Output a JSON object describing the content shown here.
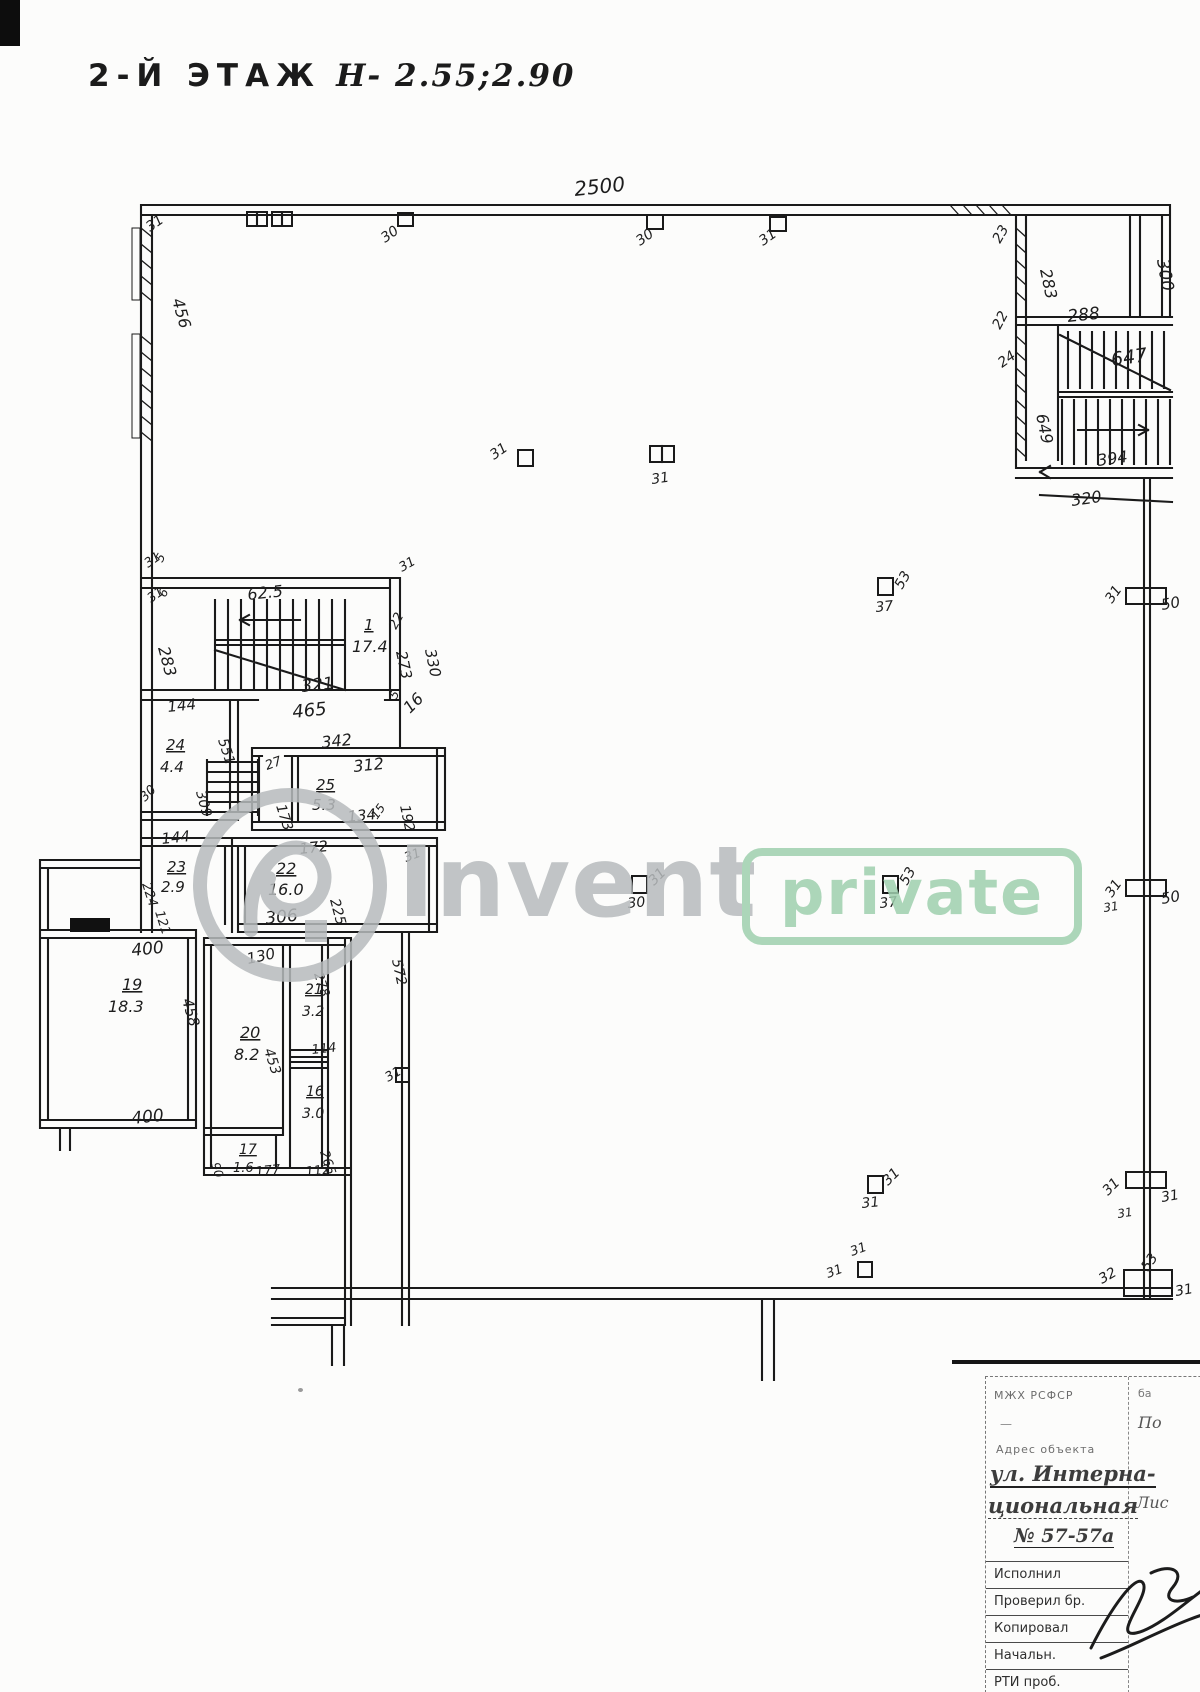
{
  "page": {
    "title_prefix": "2-Й ЭТАЖ",
    "title_value": "Н- 2.55;2.90"
  },
  "colors": {
    "ink": "#1b1b1b",
    "paper": "#fcfcfb",
    "watermark_gray": "#b7bbbd",
    "watermark_green": "#9fd0ae"
  },
  "watermark": {
    "brand": "Invent",
    "badge": "private"
  },
  "plan": {
    "labels": [
      {
        "t": "2500",
        "x": 575,
        "y": 196,
        "r": -6,
        "s": 20
      },
      {
        "t": "31",
        "x": 150,
        "y": 232,
        "r": -35,
        "s": 14
      },
      {
        "t": "30",
        "x": 385,
        "y": 243,
        "r": -35,
        "s": 14
      },
      {
        "t": "30",
        "x": 640,
        "y": 246,
        "r": -35,
        "s": 14
      },
      {
        "t": "31",
        "x": 763,
        "y": 246,
        "r": -35,
        "s": 14
      },
      {
        "t": "23",
        "x": 1000,
        "y": 244,
        "r": -60,
        "s": 14
      },
      {
        "t": "456",
        "x": 172,
        "y": 300,
        "r": 74,
        "s": 16
      },
      {
        "t": "283",
        "x": 1040,
        "y": 270,
        "r": 78,
        "s": 16
      },
      {
        "t": "288",
        "x": 1068,
        "y": 322,
        "r": -6,
        "s": 17
      },
      {
        "t": "300",
        "x": 1157,
        "y": 260,
        "r": 80,
        "s": 17
      },
      {
        "t": "22",
        "x": 1000,
        "y": 330,
        "r": -62,
        "s": 14
      },
      {
        "t": "24",
        "x": 1002,
        "y": 368,
        "r": -35,
        "s": 14
      },
      {
        "t": "647",
        "x": 1112,
        "y": 366,
        "r": -8,
        "s": 19
      },
      {
        "t": "649",
        "x": 1036,
        "y": 415,
        "r": 78,
        "s": 16
      },
      {
        "t": "394",
        "x": 1098,
        "y": 466,
        "r": -8,
        "s": 16
      },
      {
        "t": "320",
        "x": 1072,
        "y": 506,
        "r": -8,
        "s": 16
      },
      {
        "t": "31",
        "x": 148,
        "y": 568,
        "r": -35,
        "s": 13
      },
      {
        "t": "5",
        "x": 162,
        "y": 563,
        "r": -60,
        "s": 12
      },
      {
        "t": "31",
        "x": 151,
        "y": 603,
        "r": -35,
        "s": 13
      },
      {
        "t": "6",
        "x": 165,
        "y": 598,
        "r": -60,
        "s": 12
      },
      {
        "t": "62.5",
        "x": 248,
        "y": 600,
        "r": -6,
        "s": 16
      },
      {
        "t": "31",
        "x": 402,
        "y": 572,
        "r": -30,
        "s": 13
      },
      {
        "t": "22",
        "x": 396,
        "y": 630,
        "r": -62,
        "s": 13
      },
      {
        "t": "1",
        "x": 364,
        "y": 630,
        "r": 0,
        "s": 15,
        "u": true
      },
      {
        "t": "17.4",
        "x": 352,
        "y": 652,
        "r": 0,
        "s": 16
      },
      {
        "t": "273",
        "x": 396,
        "y": 652,
        "r": 78,
        "s": 15
      },
      {
        "t": "330",
        "x": 425,
        "y": 650,
        "r": 78,
        "s": 15
      },
      {
        "t": "283",
        "x": 158,
        "y": 648,
        "r": 75,
        "s": 16
      },
      {
        "t": "321",
        "x": 302,
        "y": 692,
        "r": -6,
        "s": 17
      },
      {
        "t": "465",
        "x": 293,
        "y": 718,
        "r": -6,
        "s": 18
      },
      {
        "t": "5",
        "x": 396,
        "y": 700,
        "r": -60,
        "s": 12
      },
      {
        "t": "16",
        "x": 410,
        "y": 714,
        "r": -45,
        "s": 16
      },
      {
        "t": "144",
        "x": 168,
        "y": 712,
        "r": -6,
        "s": 15
      },
      {
        "t": "551",
        "x": 218,
        "y": 740,
        "r": 72,
        "s": 14
      },
      {
        "t": "24",
        "x": 166,
        "y": 750,
        "r": 0,
        "s": 15,
        "u": true
      },
      {
        "t": "4.4",
        "x": 160,
        "y": 772,
        "r": 0,
        "s": 15
      },
      {
        "t": "309",
        "x": 196,
        "y": 792,
        "r": 75,
        "s": 14
      },
      {
        "t": "30",
        "x": 145,
        "y": 802,
        "r": -45,
        "s": 13
      },
      {
        "t": "342",
        "x": 322,
        "y": 748,
        "r": -6,
        "s": 16
      },
      {
        "t": "27",
        "x": 267,
        "y": 770,
        "r": -20,
        "s": 13
      },
      {
        "t": "312",
        "x": 354,
        "y": 772,
        "r": -6,
        "s": 16
      },
      {
        "t": "25",
        "x": 316,
        "y": 790,
        "r": 0,
        "s": 15,
        "u": true
      },
      {
        "t": "5.3",
        "x": 312,
        "y": 810,
        "r": 0,
        "s": 15
      },
      {
        "t": "173",
        "x": 276,
        "y": 806,
        "r": 72,
        "s": 14
      },
      {
        "t": "192",
        "x": 400,
        "y": 806,
        "r": 78,
        "s": 14
      },
      {
        "t": "134",
        "x": 348,
        "y": 822,
        "r": -6,
        "s": 15
      },
      {
        "t": "15",
        "x": 377,
        "y": 820,
        "r": -55,
        "s": 12
      },
      {
        "t": "172",
        "x": 300,
        "y": 854,
        "r": -6,
        "s": 15
      },
      {
        "t": "31",
        "x": 406,
        "y": 862,
        "r": -20,
        "s": 13
      },
      {
        "t": "144",
        "x": 162,
        "y": 844,
        "r": -6,
        "s": 15
      },
      {
        "t": "23",
        "x": 167,
        "y": 872,
        "r": 0,
        "s": 15,
        "u": true
      },
      {
        "t": "2.9",
        "x": 161,
        "y": 892,
        "r": 0,
        "s": 15
      },
      {
        "t": "224",
        "x": 142,
        "y": 884,
        "r": 72,
        "s": 13
      },
      {
        "t": "121",
        "x": 155,
        "y": 912,
        "r": 72,
        "s": 13
      },
      {
        "t": "22",
        "x": 276,
        "y": 874,
        "r": 0,
        "s": 16,
        "u": true
      },
      {
        "t": "16.0",
        "x": 268,
        "y": 895,
        "r": 0,
        "s": 16
      },
      {
        "t": "225",
        "x": 330,
        "y": 900,
        "r": 75,
        "s": 14
      },
      {
        "t": "306",
        "x": 266,
        "y": 924,
        "r": -6,
        "s": 17
      },
      {
        "t": "400",
        "x": 132,
        "y": 956,
        "r": -6,
        "s": 17
      },
      {
        "t": "19",
        "x": 122,
        "y": 990,
        "r": 0,
        "s": 16,
        "u": true
      },
      {
        "t": "18.3",
        "x": 108,
        "y": 1012,
        "r": 0,
        "s": 16
      },
      {
        "t": "458",
        "x": 182,
        "y": 1000,
        "r": 74,
        "s": 15
      },
      {
        "t": "400",
        "x": 132,
        "y": 1124,
        "r": -6,
        "s": 17
      },
      {
        "t": "130",
        "x": 248,
        "y": 964,
        "r": -12,
        "s": 15
      },
      {
        "t": "278",
        "x": 314,
        "y": 974,
        "r": 72,
        "s": 13
      },
      {
        "t": "21",
        "x": 305,
        "y": 994,
        "r": 0,
        "s": 14,
        "u": true
      },
      {
        "t": "3.2",
        "x": 302,
        "y": 1016,
        "r": 0,
        "s": 14
      },
      {
        "t": "20",
        "x": 240,
        "y": 1038,
        "r": 0,
        "s": 16,
        "u": true
      },
      {
        "t": "8.2",
        "x": 234,
        "y": 1060,
        "r": 0,
        "s": 16
      },
      {
        "t": "453",
        "x": 264,
        "y": 1050,
        "r": 72,
        "s": 14
      },
      {
        "t": "114",
        "x": 312,
        "y": 1054,
        "r": -6,
        "s": 13
      },
      {
        "t": "572",
        "x": 392,
        "y": 960,
        "r": 78,
        "s": 14
      },
      {
        "t": "31",
        "x": 388,
        "y": 1082,
        "r": -30,
        "s": 13
      },
      {
        "t": "16",
        "x": 306,
        "y": 1096,
        "r": 0,
        "s": 14,
        "u": true
      },
      {
        "t": "3.0",
        "x": 302,
        "y": 1118,
        "r": 0,
        "s": 14
      },
      {
        "t": "265",
        "x": 320,
        "y": 1152,
        "r": 72,
        "s": 13
      },
      {
        "t": "17",
        "x": 239,
        "y": 1154,
        "r": 0,
        "s": 14,
        "u": true
      },
      {
        "t": "1.6",
        "x": 233,
        "y": 1172,
        "r": 0,
        "s": 13
      },
      {
        "t": "90",
        "x": 211,
        "y": 1164,
        "r": 72,
        "s": 12
      },
      {
        "t": "177",
        "x": 256,
        "y": 1176,
        "r": -6,
        "s": 13
      },
      {
        "t": "112",
        "x": 306,
        "y": 1176,
        "r": -6,
        "s": 13
      },
      {
        "t": "31",
        "x": 494,
        "y": 460,
        "r": -35,
        "s": 14
      },
      {
        "t": "31",
        "x": 652,
        "y": 484,
        "r": -8,
        "s": 14
      },
      {
        "t": "53",
        "x": 902,
        "y": 590,
        "r": -60,
        "s": 14
      },
      {
        "t": "37",
        "x": 876,
        "y": 612,
        "r": -6,
        "s": 14
      },
      {
        "t": "30",
        "x": 628,
        "y": 908,
        "r": -6,
        "s": 14
      },
      {
        "t": "31",
        "x": 654,
        "y": 886,
        "r": -45,
        "s": 14
      },
      {
        "t": "53",
        "x": 907,
        "y": 886,
        "r": -60,
        "s": 14
      },
      {
        "t": "37",
        "x": 880,
        "y": 908,
        "r": -6,
        "s": 14
      },
      {
        "t": "31",
        "x": 862,
        "y": 1208,
        "r": -6,
        "s": 14
      },
      {
        "t": "31",
        "x": 888,
        "y": 1186,
        "r": -45,
        "s": 14
      },
      {
        "t": "31",
        "x": 852,
        "y": 1256,
        "r": -20,
        "s": 13
      },
      {
        "t": "31",
        "x": 828,
        "y": 1278,
        "r": -20,
        "s": 13
      },
      {
        "t": "31",
        "x": 1112,
        "y": 604,
        "r": -55,
        "s": 14
      },
      {
        "t": "50",
        "x": 1162,
        "y": 610,
        "r": -10,
        "s": 15
      },
      {
        "t": "31",
        "x": 1112,
        "y": 898,
        "r": -55,
        "s": 14
      },
      {
        "t": "50",
        "x": 1162,
        "y": 904,
        "r": -10,
        "s": 15
      },
      {
        "t": "31",
        "x": 1104,
        "y": 912,
        "r": -8,
        "s": 12
      },
      {
        "t": "31",
        "x": 1108,
        "y": 1196,
        "r": -45,
        "s": 14
      },
      {
        "t": "31",
        "x": 1162,
        "y": 1202,
        "r": -10,
        "s": 14
      },
      {
        "t": "31",
        "x": 1118,
        "y": 1218,
        "r": -8,
        "s": 12
      },
      {
        "t": "32",
        "x": 1102,
        "y": 1284,
        "r": -30,
        "s": 14
      },
      {
        "t": "53",
        "x": 1148,
        "y": 1272,
        "r": -55,
        "s": 14
      },
      {
        "t": "31",
        "x": 1176,
        "y": 1296,
        "r": -10,
        "s": 14
      }
    ]
  },
  "titleblock": {
    "org": "МЖХ РСФСР",
    "dash": "—",
    "corner_top": "ба",
    "corner_note": "По",
    "address_label": "Адрес объекта",
    "address_line1": "ул. Интерна-",
    "address_line2": "циональная",
    "address_line3": "№ 57-57а",
    "sheet_label": "Лис",
    "rows": [
      "Исполнил",
      "Проверил бр.",
      "Копировал",
      "Начальн.",
      "РТИ проб."
    ]
  }
}
